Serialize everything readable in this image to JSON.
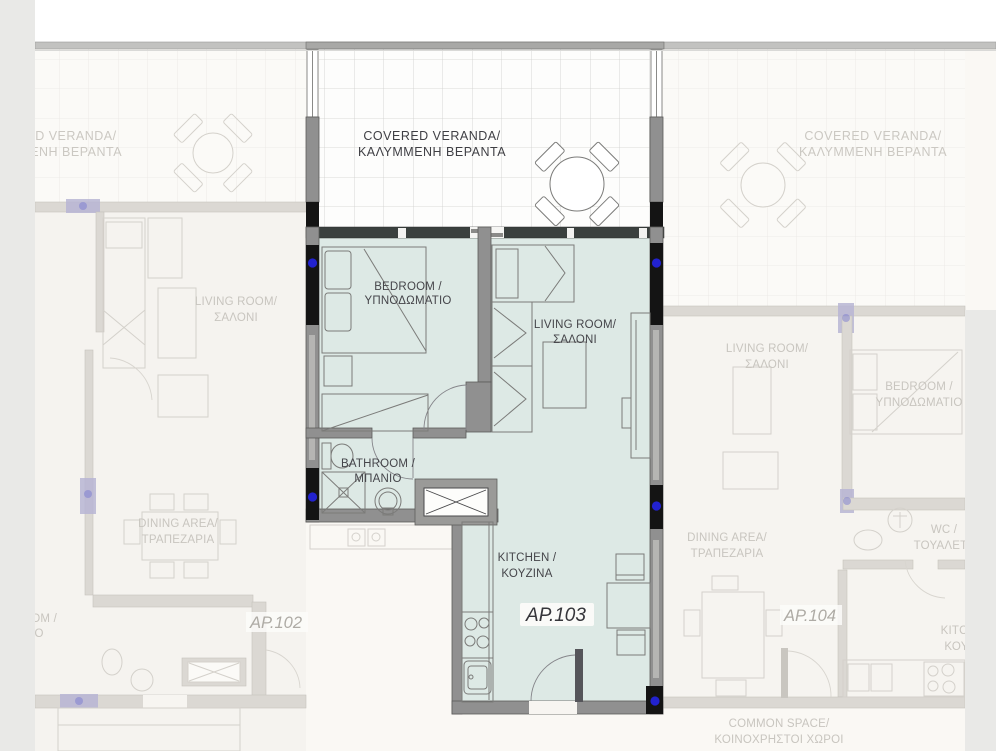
{
  "units": {
    "ap103": {
      "number": "AP.103",
      "covered_veranda_en": "COVERED VERANDA/",
      "covered_veranda_gr": "ΚΑΛΥΜΜΕΝΗ ΒΕΡΑΝΤΑ",
      "bedroom_en": "BEDROOM /",
      "bedroom_gr": "ΥΠΝΟΔΩΜΑΤΙΟ",
      "living_en": "LIVING ROOM/",
      "living_gr": "ΣΑΛΟΝΙ",
      "bathroom_en": "BATHROOM /",
      "bathroom_gr": "ΜΠΑΝΙΟ",
      "kitchen_en": "KITCHEN /",
      "kitchen_gr": "ΚΟΥΖΙΝΑ"
    },
    "ap102": {
      "number": "AP.102",
      "covered_veranda_en": "COVERED VERANDA/",
      "covered_veranda_gr": "ΚΑΛΥΜΜΕΝΗ ΒΕΡΑΝΤΑ",
      "living_en": "LIVING ROOM/",
      "living_gr": "ΣΑΛΟΝΙ",
      "dining_en": "DINING AREA/",
      "dining_gr": "ΤΡΑΠΕΖΑΡΙΑ",
      "bathroom_en": "BATHROOM /",
      "bathroom_gr": "ΜΠΑΝΙΟ"
    },
    "ap104": {
      "number": "AP.104",
      "covered_veranda_en": "COVERED VERANDA/",
      "covered_veranda_gr": "ΚΑΛΥΜΜΕΝΗ ΒΕΡΑΝΤΑ",
      "living_en": "LIVING ROOM/",
      "living_gr": "ΣΑΛΟΝΙ",
      "bedroom_en": "BEDROOM /",
      "bedroom_gr": "ΥΠΝΟΔΩΜΑΤΙΟ",
      "wc_en": "WC /",
      "wc_gr": "ΤΟΥΑΛΕΤΑ",
      "dining_en": "DINING AREA/",
      "dining_gr": "ΤΡΑΠΕΖΑΡΙΑ",
      "kitchen_en": "KITCHEN /",
      "kitchen_gr": "ΚΟΥΖΙΝΑ"
    }
  },
  "common_space": {
    "en": "COMMON SPACE/",
    "gr": "ΚΟΙΝΟΧΡΗΣΤΟΙ ΧΩΡΟΙ"
  },
  "colors": {
    "highlight_unit_fill": "#dde9e5",
    "wall_gray": "#909090",
    "window_black": "#141414",
    "marker_blue": "#2222cf",
    "faded_line": "#d4d1cb",
    "background": "#faf8f4",
    "side_band_gray": "#e9e9e7"
  }
}
